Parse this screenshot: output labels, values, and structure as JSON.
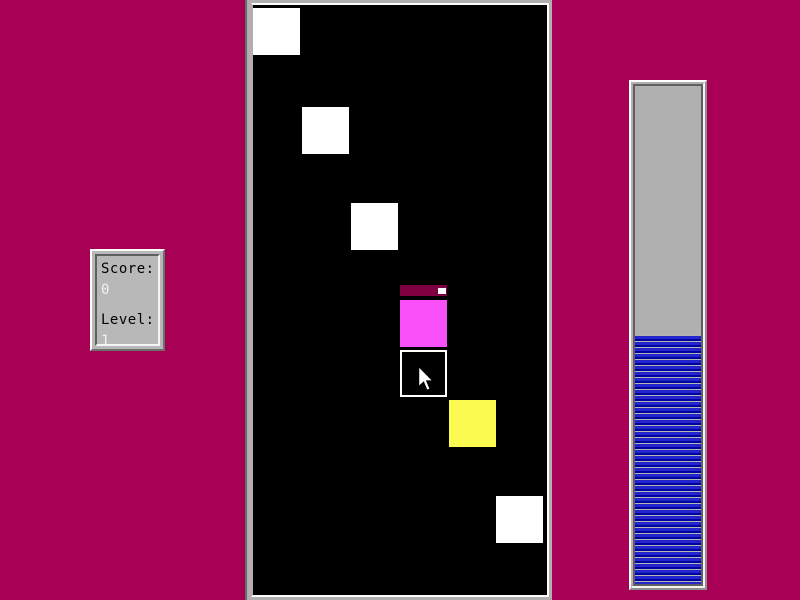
{
  "window": {
    "width": 800,
    "height": 600,
    "background_color": "#A80055"
  },
  "score_panel": {
    "score_label": "Score:",
    "score_value": "0",
    "level_label": "Level:",
    "level_value": "1"
  },
  "game_area": {
    "background_color": "#000000",
    "canvas_origin": {
      "x": 253,
      "y": 5
    },
    "squares": [
      {
        "id": "square-1",
        "x": 253,
        "y": 8,
        "size": 47,
        "fill": "#FFFFFF",
        "style": "filled"
      },
      {
        "id": "square-2",
        "x": 302,
        "y": 107,
        "size": 47,
        "fill": "#FFFFFF",
        "style": "filled"
      },
      {
        "id": "square-3",
        "x": 351,
        "y": 203,
        "size": 47,
        "fill": "#FFFFFF",
        "style": "filled"
      },
      {
        "id": "square-4",
        "x": 400,
        "y": 300,
        "size": 47,
        "fill": "#FA50FA",
        "style": "filled"
      },
      {
        "id": "square-5",
        "x": 400,
        "y": 350,
        "size": 47,
        "fill": "#000000",
        "style": "outlined",
        "border_color": "#FFFFFF"
      },
      {
        "id": "square-6",
        "x": 449,
        "y": 400,
        "size": 47,
        "fill": "#FAFA50",
        "style": "filled"
      },
      {
        "id": "square-7",
        "x": 496,
        "y": 496,
        "size": 47,
        "fill": "#FFFFFF",
        "style": "filled"
      }
    ],
    "artifacts": [
      {
        "id": "fading-strip",
        "x": 400,
        "y": 285,
        "width": 47,
        "height": 11,
        "fill": "#7E0040"
      },
      {
        "id": "white-speck",
        "x": 438,
        "y": 288,
        "width": 8,
        "height": 6,
        "fill": "#FFFFFF"
      }
    ],
    "cursor": {
      "x": 417,
      "y": 366
    }
  },
  "progress_bar": {
    "fill_percent": 50,
    "fill_color": "#2525CD",
    "fill_color_dark": "#0000A0",
    "separator_color": "#B4B4B4",
    "trough_color": "#B0B0B0"
  }
}
